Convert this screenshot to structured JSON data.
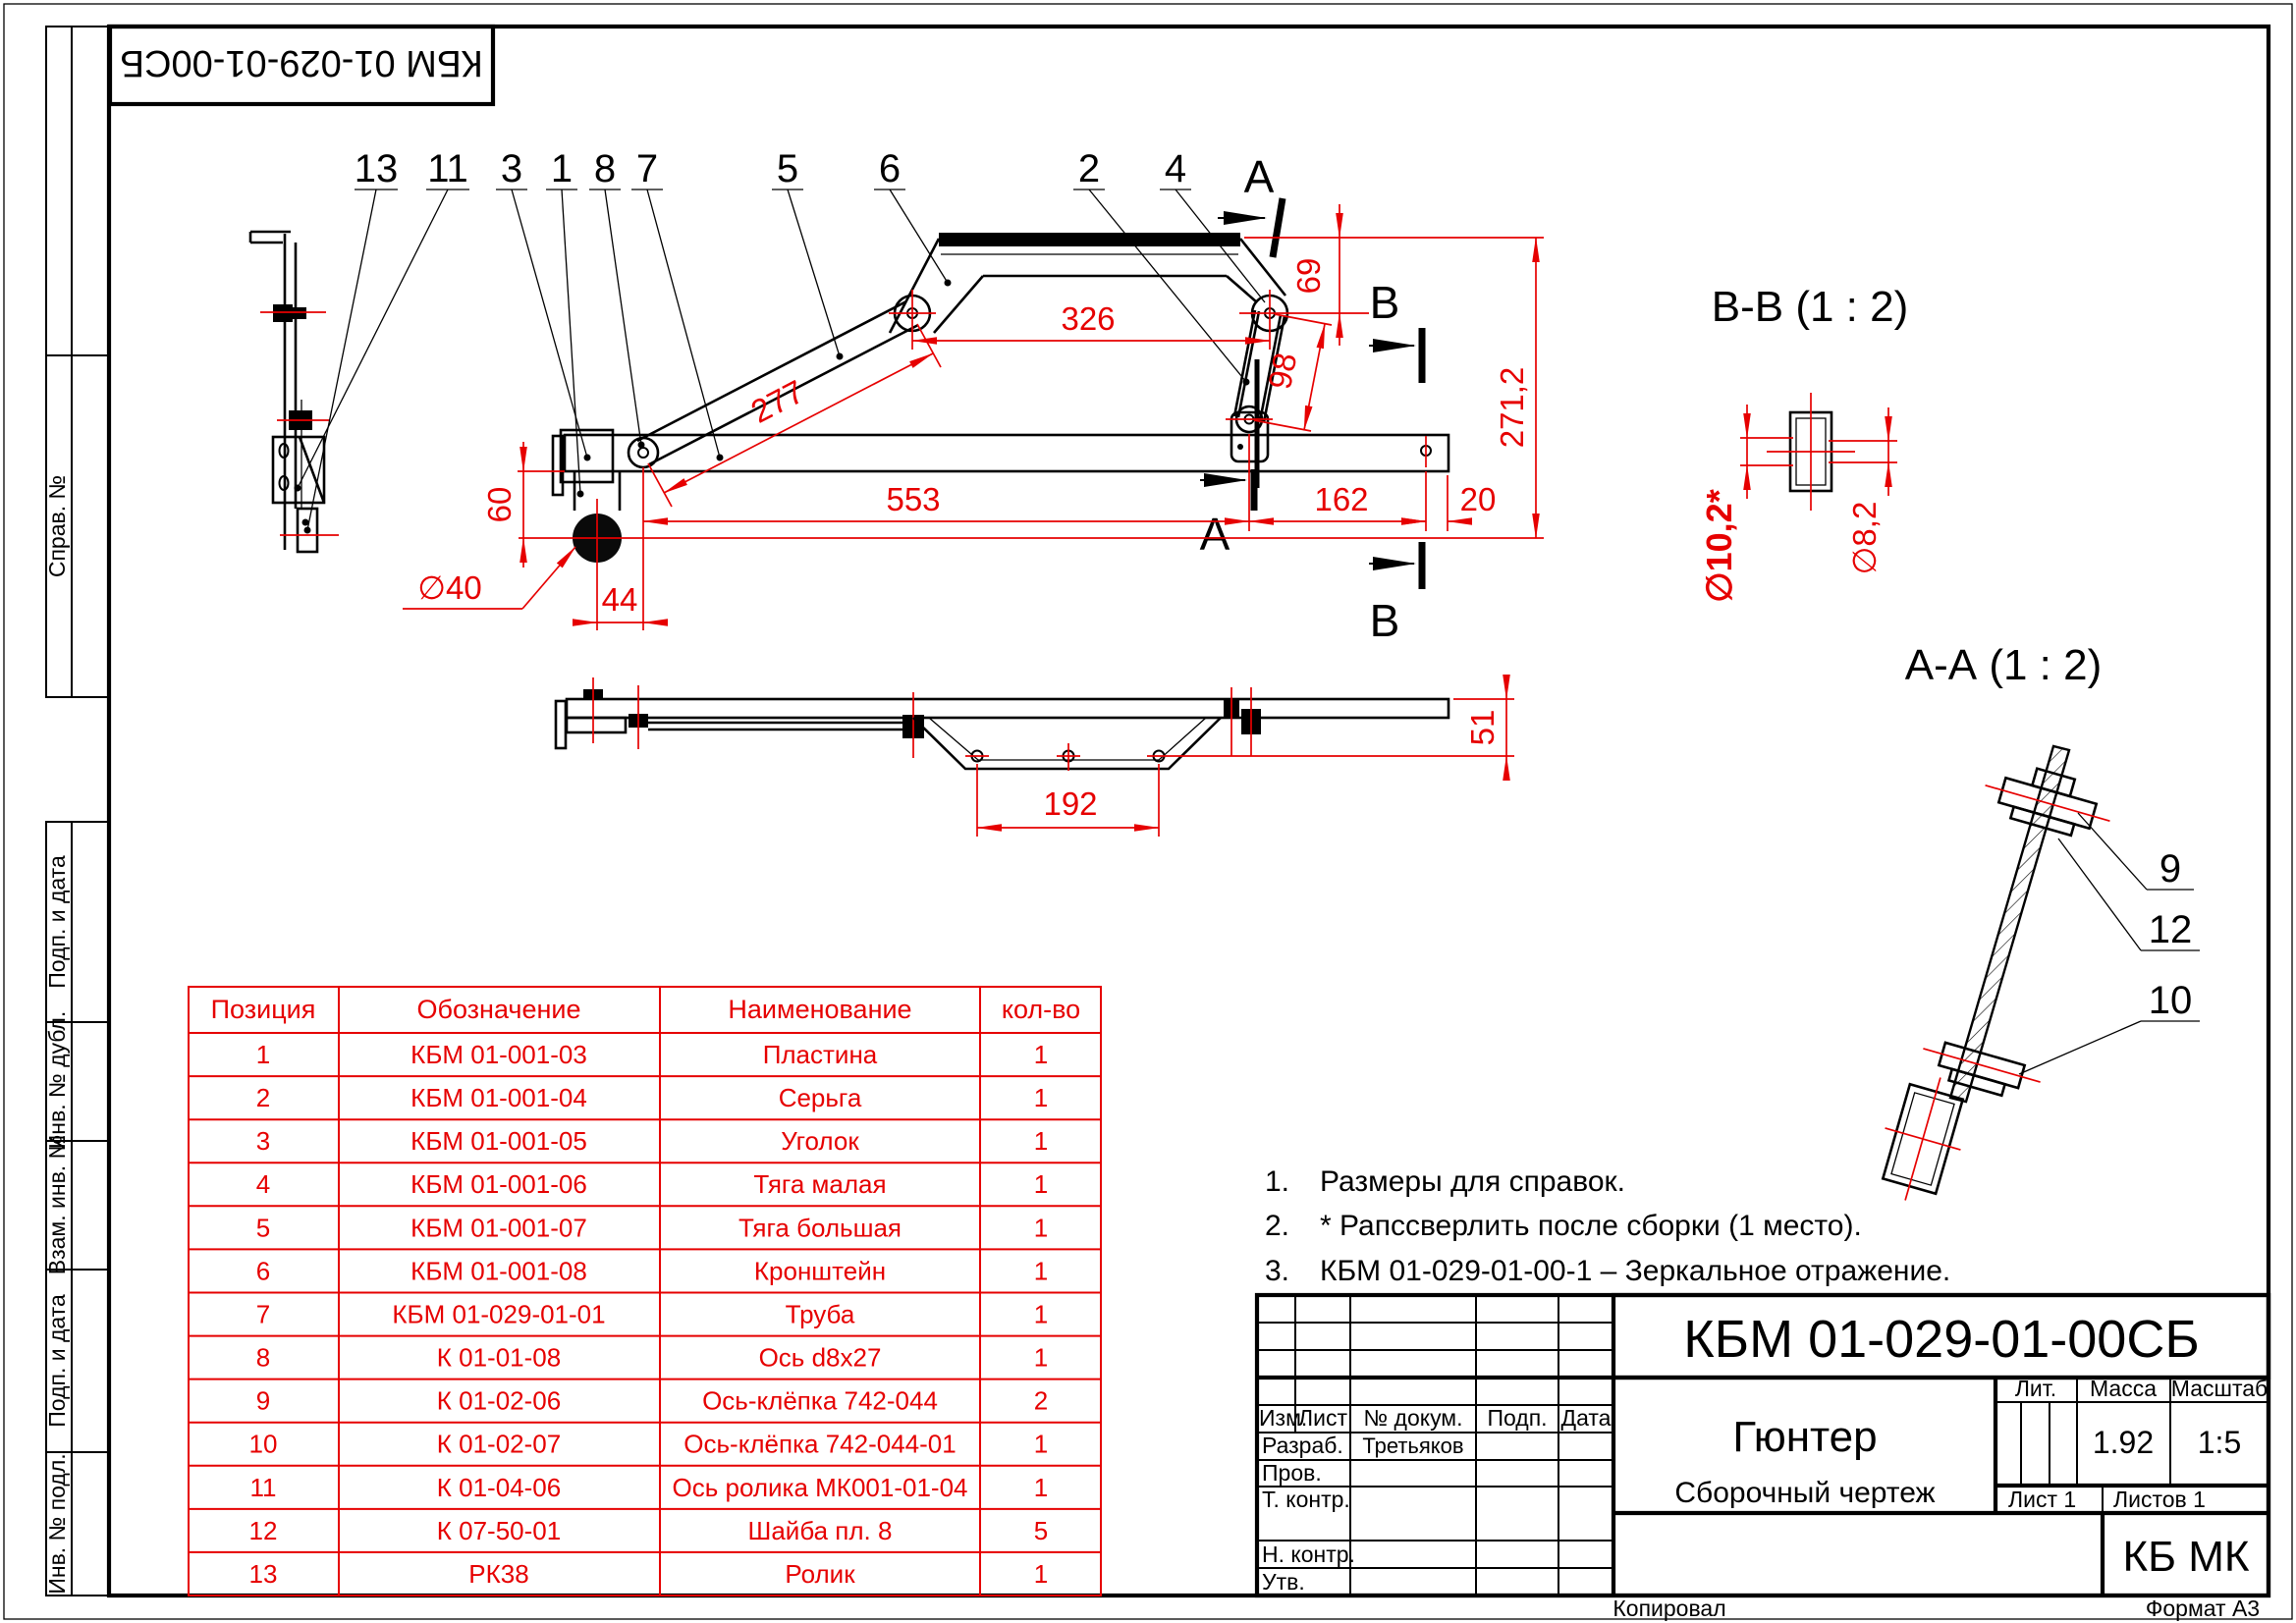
{
  "sheet": {
    "stamp": "КБМ 01-029-01-00СБ",
    "footer_copy": "Копировал",
    "footer_format": "Формат А3"
  },
  "colors": {
    "dimension_red": "#e60000",
    "drawing_black": "#000000"
  },
  "sidebar": {
    "labels": [
      "Справ. №",
      "Подп. и дата",
      "Инв. № дубл.",
      "Взам. инв. №",
      "Подп. и дата",
      "Инв. № подл."
    ]
  },
  "callouts": {
    "main": [
      "13",
      "11",
      "3",
      "1",
      "8",
      "7",
      "5",
      "6",
      "2",
      "4"
    ],
    "aa": [
      "9",
      "12",
      "10"
    ]
  },
  "sections": {
    "a_letter": "А",
    "b_letter": "В",
    "bb_title": "В-В  (1 : 2)",
    "aa_title": "А-А  (1 : 2)"
  },
  "dims": {
    "main": {
      "d69": "69",
      "d326": "326",
      "d277": "277",
      "d98": "98",
      "d271": "271,2",
      "d553": "553",
      "d162": "162",
      "d20": "20",
      "d60": "60",
      "d44": "44",
      "d40": "∅40"
    },
    "bottom": {
      "d192": "192",
      "d51": "51"
    },
    "bb": {
      "left": "∅10,2*",
      "right": "∅8,2"
    }
  },
  "notes": {
    "items": [
      {
        "num": "1.",
        "text": "Размеры для справок."
      },
      {
        "num": "2.",
        "text": "* Рапссверлить после сборки (1 место)."
      },
      {
        "num": "3.",
        "text": "КБМ 01-029-01-00-1 – Зеркальное отражение."
      }
    ]
  },
  "table": {
    "headers": [
      "Позиция",
      "Обозначение",
      "Наименование",
      "кол-во"
    ],
    "rows": [
      {
        "pos": "1",
        "code": "КБМ 01-001-03",
        "name": "Пластина",
        "qty": "1"
      },
      {
        "pos": "2",
        "code": "КБМ 01-001-04",
        "name": "Серьга",
        "qty": "1"
      },
      {
        "pos": "3",
        "code": "КБМ 01-001-05",
        "name": "Уголок",
        "qty": "1"
      },
      {
        "pos": "4",
        "code": "КБМ 01-001-06",
        "name": "Тяга малая",
        "qty": "1"
      },
      {
        "pos": "5",
        "code": "КБМ 01-001-07",
        "name": "Тяга большая",
        "qty": "1"
      },
      {
        "pos": "6",
        "code": "КБМ 01-001-08",
        "name": "Кронштейн",
        "qty": "1"
      },
      {
        "pos": "7",
        "code": "КБМ 01-029-01-01",
        "name": "Труба",
        "qty": "1"
      },
      {
        "pos": "8",
        "code": "К 01-01-08",
        "name": "Ось d8x27",
        "qty": "1"
      },
      {
        "pos": "9",
        "code": "К 01-02-06",
        "name": "Ось-клёпка 742-044",
        "qty": "2"
      },
      {
        "pos": "10",
        "code": "К 01-02-07",
        "name": "Ось-клёпка 742-044-01",
        "qty": "1"
      },
      {
        "pos": "11",
        "code": "К 01-04-06",
        "name": "Ось ролика МК001-01-04",
        "qty": "1"
      },
      {
        "pos": "12",
        "code": "К 07-50-01",
        "name": "Шайба пл. 8",
        "qty": "5"
      },
      {
        "pos": "13",
        "code": "РК38",
        "name": "Ролик",
        "qty": "1"
      }
    ]
  },
  "titleblock": {
    "doc_number": "КБМ 01-029-01-00СБ",
    "product_name": "Гюнтер",
    "doc_type": "Сборочный чертеж",
    "org": "КБ МК",
    "lit_label": "Лит.",
    "mass_label": "Масса",
    "scale_label": "Масштаб",
    "mass": "1.92",
    "scale": "1:5",
    "sheet": "Лист 1",
    "sheets": "Листов 1",
    "col_izm": "Изм.",
    "col_list": "Лист",
    "col_doc": "№ докум.",
    "col_sign": "Подп.",
    "col_date": "Дата",
    "row_razrab": "Разраб.",
    "row_prov": "Пров.",
    "row_tkontr": "Т. контр.",
    "row_nkontr": "Н. контр.",
    "row_utv": "Утв.",
    "razrab_name": "Третьяков"
  }
}
